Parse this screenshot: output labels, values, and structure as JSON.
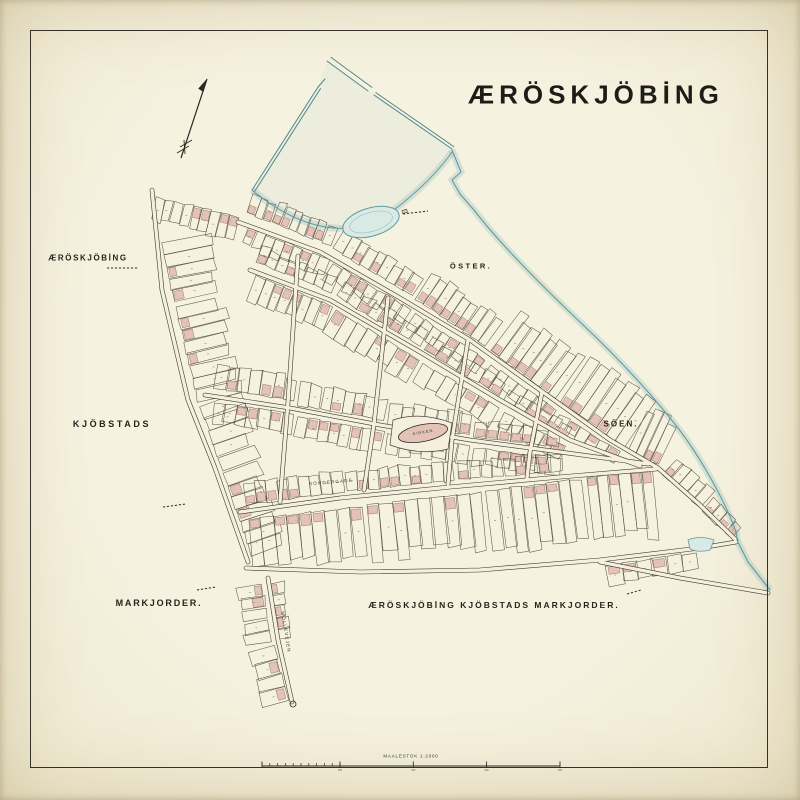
{
  "map": {
    "title": "ÆRÖSKJÖBİNG",
    "region_labels": {
      "west_town": "ÆRÖSKJÖBİNG",
      "oster": "ÖSTER.",
      "kjobstads": "KJÖBSTADS",
      "soen": "SÖEN.",
      "markjorder": "MARKJORDER.",
      "bottom_caption": "ÆRÖSKJÖBİNG KJÖBSTADS MARKJORDER."
    },
    "street_labels": {
      "sondergade": "SÖNDERGADE",
      "mollevejen": "MÖLLEVEJEN",
      "kirken": "KIRKEN"
    },
    "scale_bar": {
      "caption": "MAALESTOK 1:2000"
    },
    "colors": {
      "paper": "#f4f0dd",
      "ink": "#2c2a24",
      "plot_line": "#4c473b",
      "street_edge": "#3b382f",
      "water_line": "#5f9aa0",
      "water_glow": "rgba(139,184,187,0.30)",
      "water_fill": "#d9e9e3",
      "building_pink": "#e4c2b6",
      "building_edge": "#9b7a6e"
    }
  }
}
